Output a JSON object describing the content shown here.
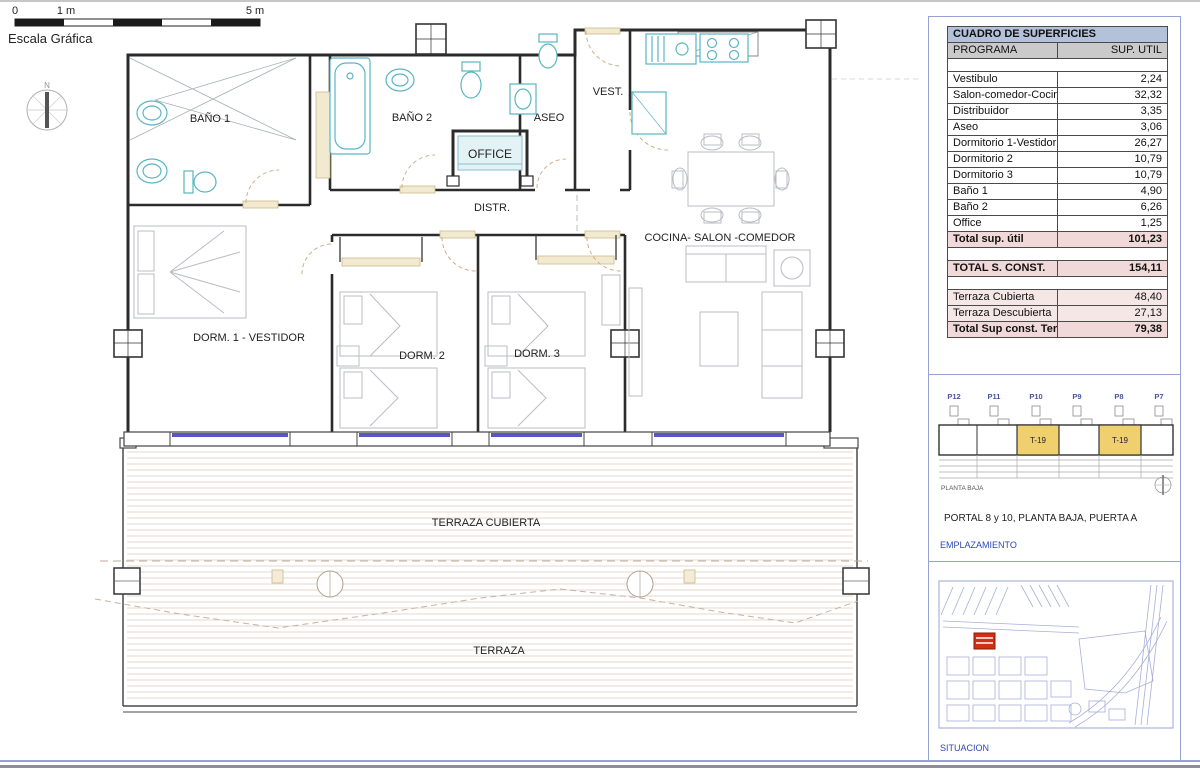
{
  "colors": {
    "accent_blue": "#2b49b8",
    "panel_frame": "#96a2d2",
    "table_title_bg": "#b3c1d9",
    "table_header_bg": "#cacaca",
    "table_total_bg": "#f1d9d9",
    "table_terrace_bg": "#f6e7e7",
    "highlight_yellow": "#f0d06e",
    "window_purple": "#5a55c2",
    "fixture_cyan": "#58b6c2",
    "site_marker_red": "#d22f12"
  },
  "scale_bar": {
    "label": "Escala Gráfica",
    "tick_0": "0",
    "tick_1": "1 m",
    "tick_5": "5 m"
  },
  "compass": {
    "north_label": "N"
  },
  "floor_plan": {
    "rooms": {
      "bano1": "BAÑO 1",
      "bano2": "BAÑO 2",
      "aseo": "ASEO",
      "vest": "VEST.",
      "office": "OFFICE",
      "distr": "DISTR.",
      "salon": "COCINA- SALON -COMEDOR",
      "dorm1": "DORM. 1 - VESTIDOR",
      "dorm2": "DORM. 2",
      "dorm3": "DORM. 3",
      "terraza_cubierta": "TERRAZA CUBIERTA",
      "terraza": "TERRAZA"
    }
  },
  "surfaces_table": {
    "title": "CUADRO DE SUPERFICIES",
    "columns": {
      "program": "PROGRAMA",
      "area": "SUP. UTIL"
    },
    "rows": [
      {
        "label": "Vestibulo",
        "value": "2,24"
      },
      {
        "label": "Salon-comedor-Cocina",
        "value": "32,32"
      },
      {
        "label": "Distribuidor",
        "value": "3,35"
      },
      {
        "label": "Aseo",
        "value": "3,06"
      },
      {
        "label": "Dormitorio 1-Vestidor",
        "value": "26,27"
      },
      {
        "label": "Dormitorio 2",
        "value": "10,79"
      },
      {
        "label": "Dormitorio 3",
        "value": "10,79"
      },
      {
        "label": "Baño 1",
        "value": "4,90"
      },
      {
        "label": "Baño 2",
        "value": "6,26"
      },
      {
        "label": "Office",
        "value": "1,25"
      }
    ],
    "total_util": {
      "label": "Total sup. útil",
      "value": "101,23"
    },
    "total_built": {
      "label": "TOTAL S. CONST.",
      "value": "154,11"
    },
    "terrace_rows": [
      {
        "label": "Terraza Cubierta",
        "value": "48,40"
      },
      {
        "label": "Terraza Descubierta",
        "value": "27,13"
      }
    ],
    "total_terraces": {
      "label": "Total Sup const. Terrazas",
      "value": "79,38"
    }
  },
  "emplazamiento": {
    "plots": [
      "P12",
      "P11",
      "P10",
      "P9",
      "P8",
      "P7"
    ],
    "unit_label": "T-19",
    "floor_label": "PLANTA BAJA",
    "portal_text": "PORTAL 8 y 10, PLANTA BAJA, PUERTA A",
    "section_label": "EMPLAZAMIENTO"
  },
  "situacion": {
    "section_label": "SITUACION"
  }
}
